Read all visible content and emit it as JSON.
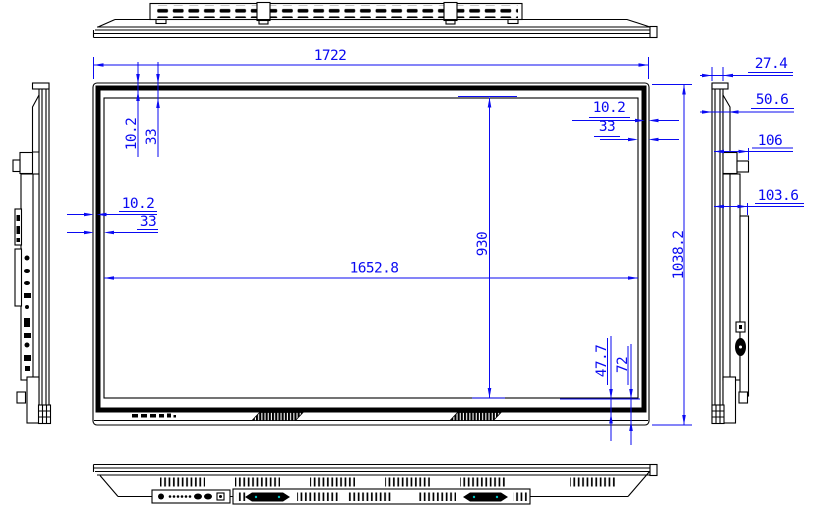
{
  "drawing": {
    "type": "technical-drawing",
    "subject": "flat-panel display, five-view dimensional drawing",
    "units": "mm",
    "colors": {
      "dimension": "#0a0af2",
      "outline": "#000000",
      "connector_accent": "#00c2c2"
    },
    "dims": {
      "overall_width": "1722",
      "overall_height": "1038.2",
      "active_width": "1652.8",
      "active_height": "930",
      "bezel_inner": "10.2",
      "bezel_outer": "33",
      "bottom_inner": "47.7",
      "bottom_outer": "72",
      "depth_front": "27.4",
      "depth_mid": "50.6",
      "depth_handle": "106",
      "depth_bracket": "103.6"
    }
  }
}
